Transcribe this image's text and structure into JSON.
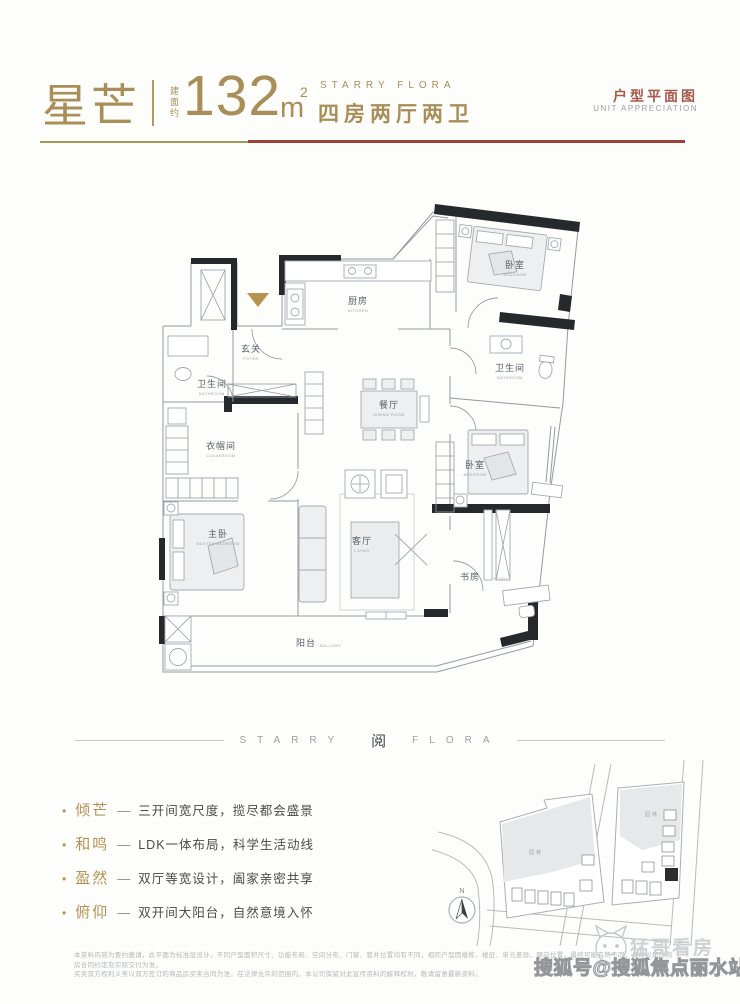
{
  "header": {
    "name_zh": "星芒",
    "area_prefix": "建面约",
    "area_value": "132",
    "area_unit": "m",
    "area_sup": "2",
    "series_en": "STARRY FLORA",
    "layout_zh": "四房两厅两卫",
    "right_title_zh": "户型平面图",
    "right_title_en": "UNIT APPRECIATION"
  },
  "colors": {
    "gold": "#a98e58",
    "rule_gold": "#a59a55",
    "rule_red": "#9c4136",
    "wall_black": "#26292c",
    "plan_line": "#949aa1",
    "highlight_building": "#2b2e31"
  },
  "floorplan": {
    "entry_marker": "entry-triangle",
    "rooms": [
      {
        "zh": "厨房",
        "en": "KITCHEN"
      },
      {
        "zh": "玄关",
        "en": "FOYER"
      },
      {
        "zh": "卫生间",
        "en": "BATHROOM"
      },
      {
        "zh": "衣帽间",
        "en": "CLOAKROOM"
      },
      {
        "zh": "主卧",
        "en": "MASTER BEDROOM"
      },
      {
        "zh": "餐厅",
        "en": "DINING ROOM"
      },
      {
        "zh": "客厅",
        "en": "LIVING"
      },
      {
        "zh": "卧室",
        "en": "BEDROOM"
      },
      {
        "zh": "卫生间",
        "en": "BATHROOM"
      },
      {
        "zh": "卧室",
        "en": "BEDROOM"
      },
      {
        "zh": "书房",
        "en": "STUDY"
      },
      {
        "zh": "阳台",
        "en": "BALCONY"
      }
    ]
  },
  "band": {
    "left": "STARRY",
    "logo": "阅",
    "right": "FLORA"
  },
  "features_bullet": "•",
  "features_sep": "—",
  "features": [
    {
      "title": "倾芒",
      "desc": "三开间宽尺度，揽尽都会盛景"
    },
    {
      "title": "和鸣",
      "desc": "LDK一体布局，科学生活动线"
    },
    {
      "title": "盈然",
      "desc": "双厅等宽设计，阖家亲密共享"
    },
    {
      "title": "俯仰",
      "desc": "双开间大阳台，自然意境入怀"
    }
  ],
  "sitemap": {
    "compass_label": "N",
    "garden_label_left": "园林",
    "garden_label_right": "园林"
  },
  "footer": {
    "disclaimer_line1": "本资料内容为要约邀请，此平面为标准层设计，不同户型面积尺寸、功能布局、空间分布、门窗、管井位置均有不同，相同户型因楼栋、楼层、单元差异、朝向位置，最终可能有所不同，具体以届时购房合同约定及实际交付为准。",
    "disclaimer_line2": "买卖双方权利义务以双方签订的商品房买卖合同为准。在法律允许的范围内，本公司保留对此宣传资料的解释权利，敬请留意最新资料。"
  },
  "watermark": {
    "publisher": "搜狐号@搜狐焦点丽水站",
    "logo_text": "猛哥看房"
  }
}
